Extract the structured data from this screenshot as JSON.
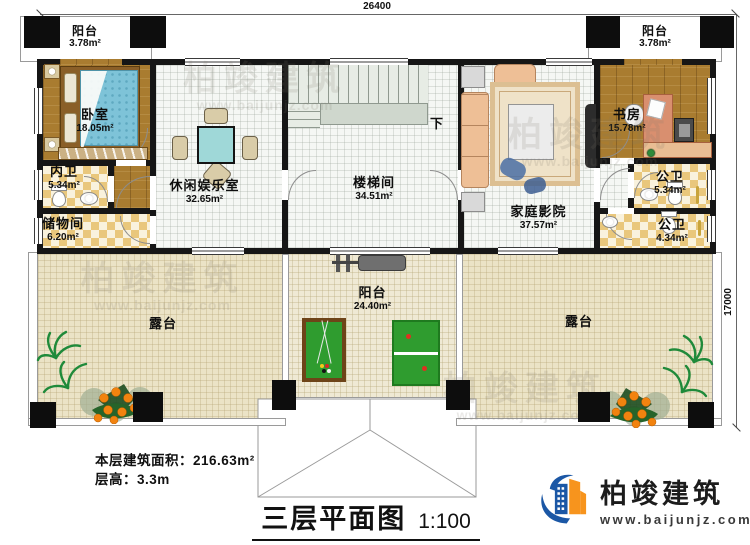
{
  "dimensions": {
    "top": "26400",
    "right": "17000"
  },
  "rooms": [
    {
      "id": "balcony-top-left",
      "name": "阳台",
      "area": "3.78m²"
    },
    {
      "id": "balcony-top-right",
      "name": "阳台",
      "area": "3.78m²"
    },
    {
      "id": "bedroom",
      "name": "卧室",
      "area": "18.05m²"
    },
    {
      "id": "ensuite-bath",
      "name": "内卫",
      "area": "5.34m²"
    },
    {
      "id": "storage",
      "name": "储物间",
      "area": "6.20m²"
    },
    {
      "id": "recreation-room",
      "name": "休闲娱乐室",
      "area": "32.65m²"
    },
    {
      "id": "stairwell",
      "name": "楼梯间",
      "area": "34.51m²"
    },
    {
      "id": "home-theater",
      "name": "家庭影院",
      "area": "37.57m²"
    },
    {
      "id": "study",
      "name": "书房",
      "area": "15.78m²"
    },
    {
      "id": "public-bath-1",
      "name": "公卫",
      "area": "5.34m²"
    },
    {
      "id": "public-bath-2",
      "name": "公卫",
      "area": "4.34m²"
    },
    {
      "id": "main-balcony",
      "name": "阳台",
      "area": "24.40m²"
    },
    {
      "id": "terrace-left",
      "name": "露台"
    },
    {
      "id": "terrace-right",
      "name": "露台"
    }
  ],
  "stairs": {
    "down": "下"
  },
  "footer": {
    "area_label": "本层建筑面积：",
    "area_value": "216.63m²",
    "height_label": "层高：",
    "height_value": "3.3m"
  },
  "title": {
    "text": "三层平面图",
    "scale": "1:100"
  },
  "brand": {
    "name": "柏竣建筑",
    "url": "www.baijunjz.com"
  },
  "watermark": {
    "name": "柏竣建筑",
    "url": "www.baijunjz.com"
  },
  "colors": {
    "brand_blue": "#1b57a5",
    "brand_orange": "#f7941d",
    "wall": "#161616",
    "wood": "#a97c30"
  }
}
